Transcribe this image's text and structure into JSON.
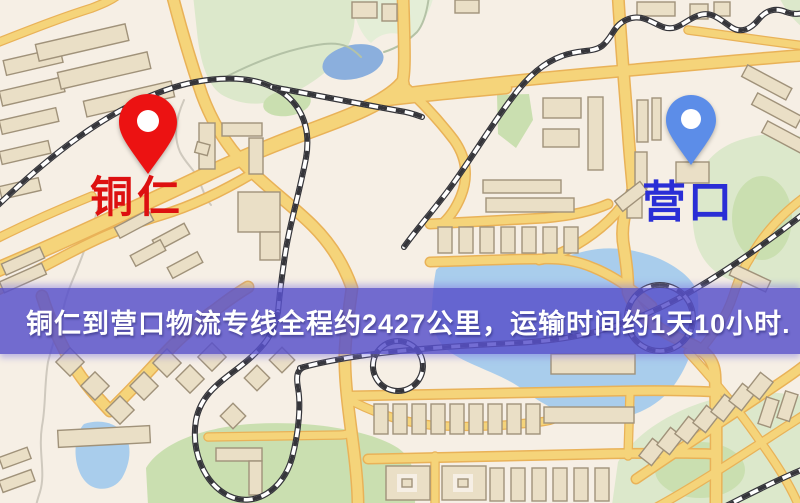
{
  "banner": {
    "text": "铜仁到营口物流专线全程约2427公里，运输时间约1天10小时."
  },
  "markers": {
    "origin": {
      "label": "铜仁",
      "pin_color": "#ec1212",
      "label_color": "#dd1010"
    },
    "destination": {
      "label": "营口",
      "pin_color": "#5c8de8",
      "label_color": "#2a2ed6"
    }
  },
  "map_colors": {
    "background": "#f6efe5",
    "road_fill": "#f5d47a",
    "road_casing": "#e9b258",
    "building_fill": "#eadfc6",
    "building_stroke": "#a0927a",
    "park": "#dce8cb",
    "park_dark": "#cadfb0",
    "water": "#a9cdec",
    "railway": "#35353a",
    "banner_bg": "rgba(88,81,202,0.84)",
    "banner_text_color": "#ffffff"
  }
}
